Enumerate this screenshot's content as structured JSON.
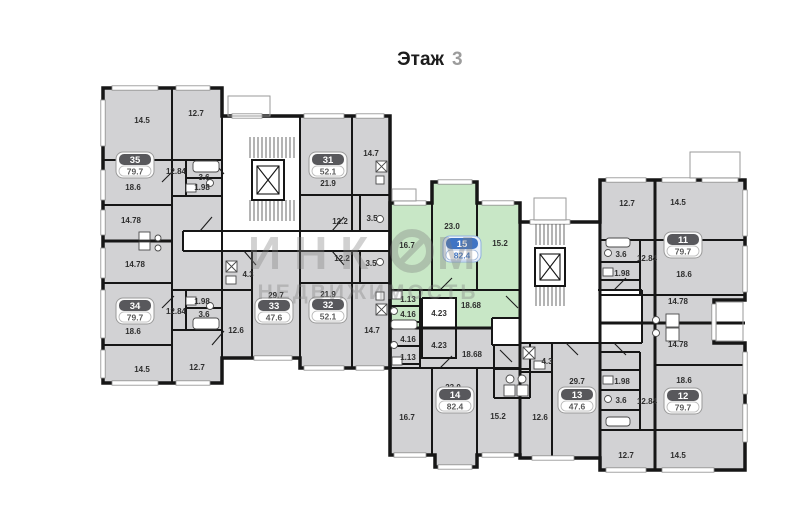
{
  "title": {
    "label": "Этаж",
    "number": "3"
  },
  "watermark": {
    "brand_part1": "ИНК",
    "brand_part2": "М",
    "brand_line2": "НЕДВИЖИМОСТЬ",
    "logo": "ring-logo"
  },
  "colors": {
    "room_fill": "#d2d2d4",
    "highlight_fill": "#c8e7c6",
    "wall": "#161616",
    "badge_dark": "#58585c",
    "badge_blue": "#3f74c4",
    "window_line": "#8f8f8f"
  },
  "legend": {
    "highlighted_apartment": "15",
    "stairwell": "stairs-and-elevator-core"
  },
  "apartments": [
    {
      "id": "35",
      "area": "79.7",
      "highlighted": false,
      "rooms": [
        {
          "v": "14.5"
        },
        {
          "v": "12.7"
        },
        {
          "v": "12.84"
        },
        {
          "v": "3.6"
        },
        {
          "v": "1.98"
        },
        {
          "v": "18.6"
        },
        {
          "v": "14.78"
        }
      ]
    },
    {
      "id": "34",
      "area": "79.7",
      "highlighted": false,
      "rooms": [
        {
          "v": "14.78"
        },
        {
          "v": "1.98"
        },
        {
          "v": "12.84"
        },
        {
          "v": "3.6"
        },
        {
          "v": "18.6"
        },
        {
          "v": "14.5"
        },
        {
          "v": "12.7"
        }
      ]
    },
    {
      "id": "33",
      "area": "47.6",
      "highlighted": false,
      "rooms": [
        {
          "v": "4.3"
        },
        {
          "v": "29.7"
        },
        {
          "v": "12.6"
        }
      ]
    },
    {
      "id": "32",
      "area": "52.1",
      "highlighted": false,
      "rooms": [
        {
          "v": "12.2"
        },
        {
          "v": "3.5"
        },
        {
          "v": "21.9"
        },
        {
          "v": "14.7"
        }
      ]
    },
    {
      "id": "31",
      "area": "52.1",
      "highlighted": false,
      "rooms": [
        {
          "v": "14.7"
        },
        {
          "v": "21.9"
        },
        {
          "v": "12.2"
        },
        {
          "v": "3.5"
        }
      ]
    },
    {
      "id": "15",
      "area": "82.4",
      "highlighted": true,
      "rooms": [
        {
          "v": "23.0"
        },
        {
          "v": "16.7"
        },
        {
          "v": "15.2"
        },
        {
          "v": "1.13"
        },
        {
          "v": "4.16"
        },
        {
          "v": "4.23"
        },
        {
          "v": "18.68"
        }
      ]
    },
    {
      "id": "14",
      "area": "82.4",
      "highlighted": false,
      "rooms": [
        {
          "v": "4.23"
        },
        {
          "v": "4.16"
        },
        {
          "v": "1.13"
        },
        {
          "v": "18.68"
        },
        {
          "v": "23.0"
        },
        {
          "v": "16.7"
        },
        {
          "v": "15.2"
        }
      ]
    },
    {
      "id": "13",
      "area": "47.6",
      "highlighted": false,
      "rooms": [
        {
          "v": "4.3"
        },
        {
          "v": "29.7"
        },
        {
          "v": "12.6"
        }
      ]
    },
    {
      "id": "12",
      "area": "79.7",
      "highlighted": false,
      "rooms": [
        {
          "v": "14.78"
        },
        {
          "v": "18.6"
        },
        {
          "v": "1.98"
        },
        {
          "v": "3.6"
        },
        {
          "v": "12.84"
        },
        {
          "v": "12.7"
        },
        {
          "v": "14.5"
        }
      ]
    },
    {
      "id": "11",
      "area": "79.7",
      "highlighted": false,
      "rooms": [
        {
          "v": "12.7"
        },
        {
          "v": "14.5"
        },
        {
          "v": "3.6"
        },
        {
          "v": "12.84"
        },
        {
          "v": "1.98"
        },
        {
          "v": "18.6"
        },
        {
          "v": "14.78"
        }
      ]
    }
  ]
}
